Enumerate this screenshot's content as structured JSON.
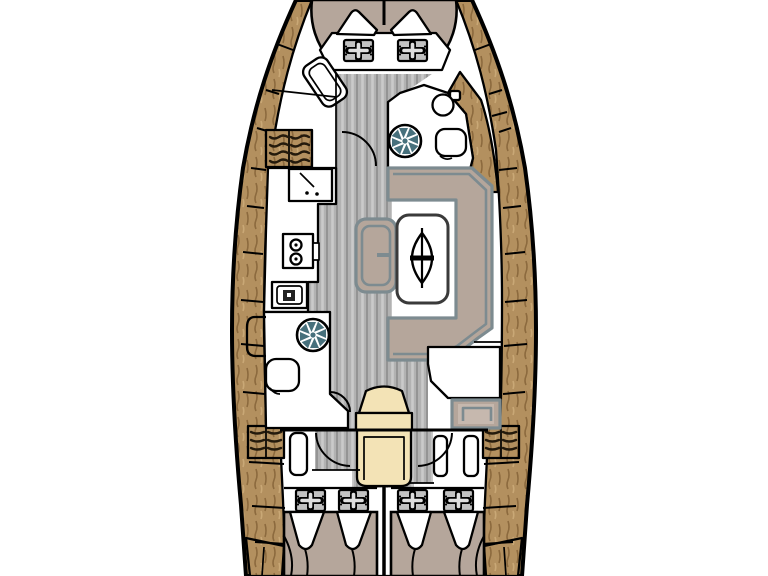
{
  "figure": {
    "type": "boat-interior-floor-plan",
    "orientation": "bow-up"
  },
  "palette": {
    "background": "#ffffff",
    "outline": "#000000",
    "wood": "#b3905f",
    "wood_streak_dark": "#8c6a3e",
    "wood_streak_light": "#c9a876",
    "floor": "#b2b2b2",
    "floor_stripe_light": "#cacaca",
    "floor_stripe_dark": "#949494",
    "cushion": "#b5a69b",
    "cushion_light": "#c6b8ae",
    "cushion_outline": "#7d8b90",
    "stairs": "#f3e3b6",
    "hatch": "#c2c2c2",
    "hatch_cross": "#dedede",
    "drain_fan": "#47707c",
    "appliance_dark": "#222222",
    "white": "#ffffff"
  },
  "icons": {
    "hatch": "deck-hatch-cross-icon",
    "fan": "shower-drain-fan-icon",
    "table_symbol": "table-extension-oval-icon",
    "burner": "stove-burner-icon"
  }
}
